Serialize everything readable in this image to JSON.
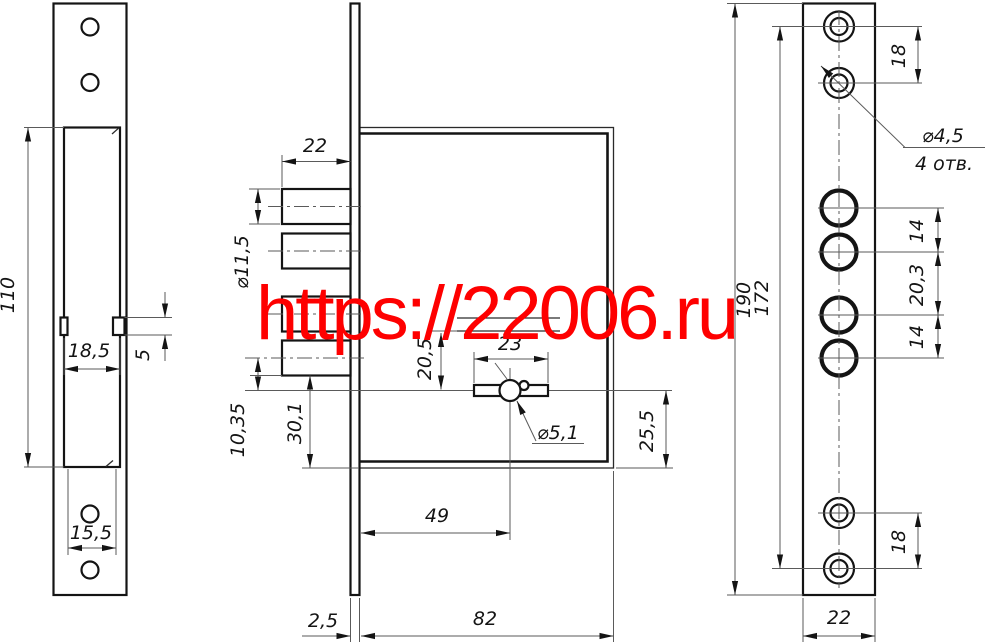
{
  "watermark": {
    "text": "https://22006.ru",
    "color": "#fe0000"
  },
  "views": {
    "strike_plate": {
      "name": "strike plate side view",
      "dims": {
        "cutout_height": "110",
        "cutout_width": "18,5",
        "tab_height": "5",
        "hole_span": "15,5"
      }
    },
    "lock_body": {
      "name": "lock body main view",
      "dims": {
        "bolt_throw": "22",
        "bolt_diameter": "⌀11,5",
        "bolt_to_key_axis": "10,35",
        "bolt_to_bottom": "30,1",
        "slot_to_key_axis": "20,5",
        "key_slot_width": "23",
        "key_pin_diameter": "⌀5,1",
        "key_axis_to_bottom": "25,5",
        "backset": "49",
        "faceplate_thickness": "2,5",
        "body_depth": "82"
      }
    },
    "faceplate": {
      "name": "faceplate front view",
      "dims": {
        "screw_span_top": "18",
        "screw_hole_diameter": "⌀4,5",
        "screw_hole_count": "4 отв.",
        "bolt_pitch_1": "14",
        "bolt_pitch_2": "20,3",
        "bolt_pitch_3": "14",
        "hole_field_height": "172",
        "plate_height": "190",
        "screw_span_bottom": "18",
        "plate_width": "22"
      }
    }
  }
}
